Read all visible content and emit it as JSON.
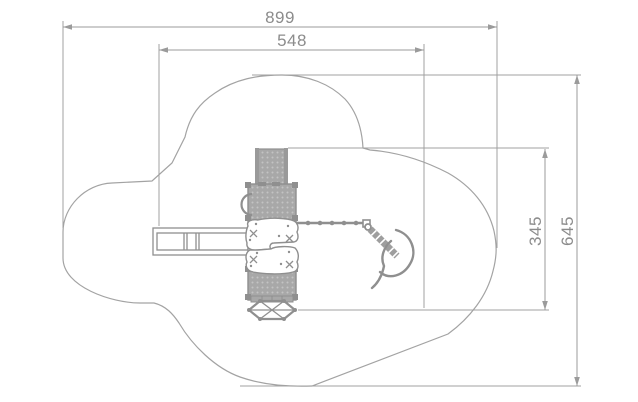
{
  "page": {
    "background": "#ffffff",
    "type": "technical-plan-drawing"
  },
  "drawing": {
    "subject": "playground-equipment-top-view-with-safety-area",
    "line_color": "#9a9a9a",
    "equipment_fill": "#a8a8a8",
    "equipment_dot_color": "#c3c3c3",
    "text_color": "#8c8c8c",
    "dimensions": [
      {
        "id": "overall-width",
        "label": "899",
        "orientation": "horizontal"
      },
      {
        "id": "inner-width",
        "label": "548",
        "orientation": "horizontal"
      },
      {
        "id": "inner-depth",
        "label": "345",
        "orientation": "vertical"
      },
      {
        "id": "overall-depth",
        "label": "645",
        "orientation": "vertical"
      }
    ]
  }
}
